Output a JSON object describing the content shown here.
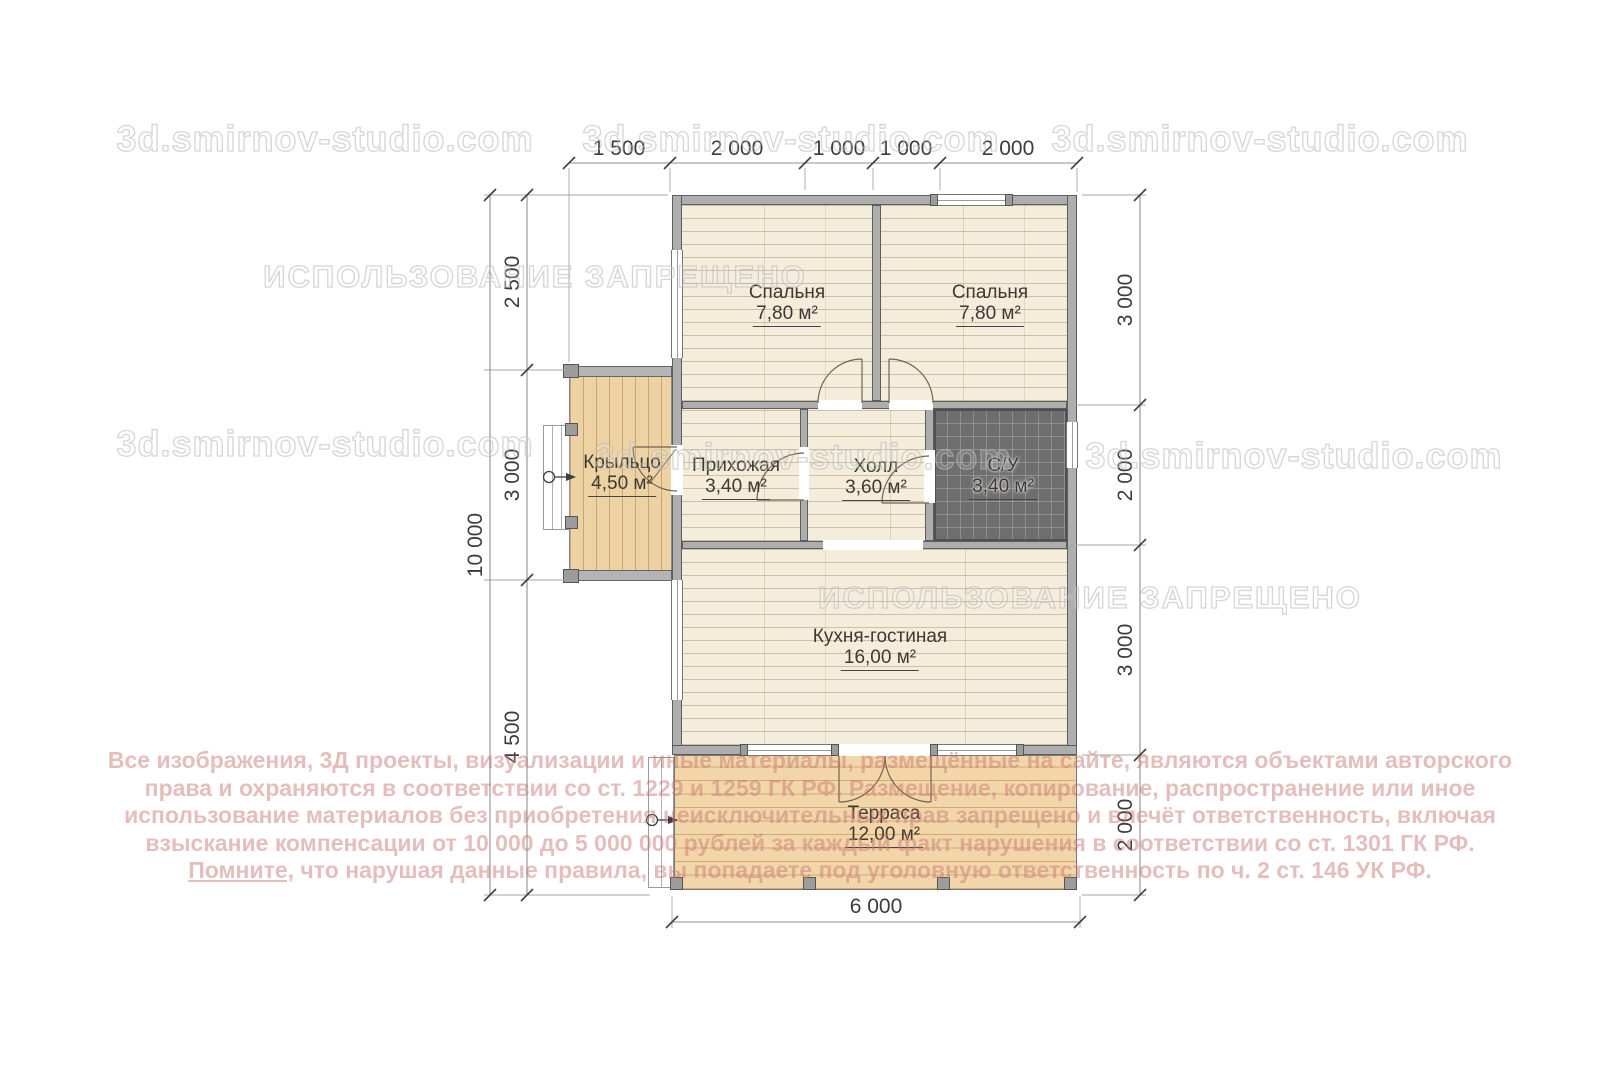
{
  "watermarks": {
    "site": "3d.smirnov-studio.com",
    "forbidden": "ИСПОЛЬЗОВАНИЕ ЗАПРЕЩЕНО"
  },
  "rooms": {
    "bedroom1": {
      "name": "Спальня",
      "area": "7,80 м²"
    },
    "bedroom2": {
      "name": "Спальня",
      "area": "7,80 м²"
    },
    "hallway": {
      "name": "Прихожая",
      "area": "3,40 м²"
    },
    "hall": {
      "name": "Холл",
      "area": "3,60 м²"
    },
    "bathroom": {
      "name": "С/У",
      "area": "3,40 м²"
    },
    "kitchen": {
      "name": "Кухня-гостиная",
      "area": "16,00 м²"
    },
    "terrace": {
      "name": "Терраса",
      "area": "12,00 м²"
    },
    "porch": {
      "name": "Крыльцо",
      "area": "4,50 м²"
    }
  },
  "dimensions": {
    "top": [
      "1 500",
      "2 000",
      "1 000",
      "1 000",
      "2 000"
    ],
    "left_outer": "10 000",
    "left_inner": [
      "2 500",
      "3 000",
      "4 500"
    ],
    "right": [
      "3 000",
      "2 000",
      "3 000",
      "2 000"
    ],
    "bottom": "6 000"
  },
  "copyright": {
    "line1": "Все изображения, 3Д проекты, визуализации и иные материалы, размещённые на сайте, являются объектами авторского",
    "line2": "права и охраняются в соответствии со ст. 1229 и 1259 ГК РФ. Размещение, копирование, распространение или иное",
    "line3": "использование материалов без приобретения неисключительных прав запрещено и влечёт ответственность, включая",
    "line4": "взыскание компенсации от 10 000 до 5 000 000 рублей за каждый факт нарушения в соответствии со ст. 1301 ГК РФ.",
    "line5_lead": "Помните,",
    "line5_rest": " что нарушая данные правила, вы попадаете под уголовную ответственность по ч. 2 ст. 146 УК РФ."
  },
  "colors": {
    "wall": "#aeaeae",
    "floor_wood_light": "#f4eddc",
    "floor_porch": "#edd2a4",
    "floor_terrace": "#f2d6a9",
    "bathroom_tile": "#6e6e6e",
    "copyright_text": "#c67872",
    "watermark": "#b9b9b9"
  }
}
